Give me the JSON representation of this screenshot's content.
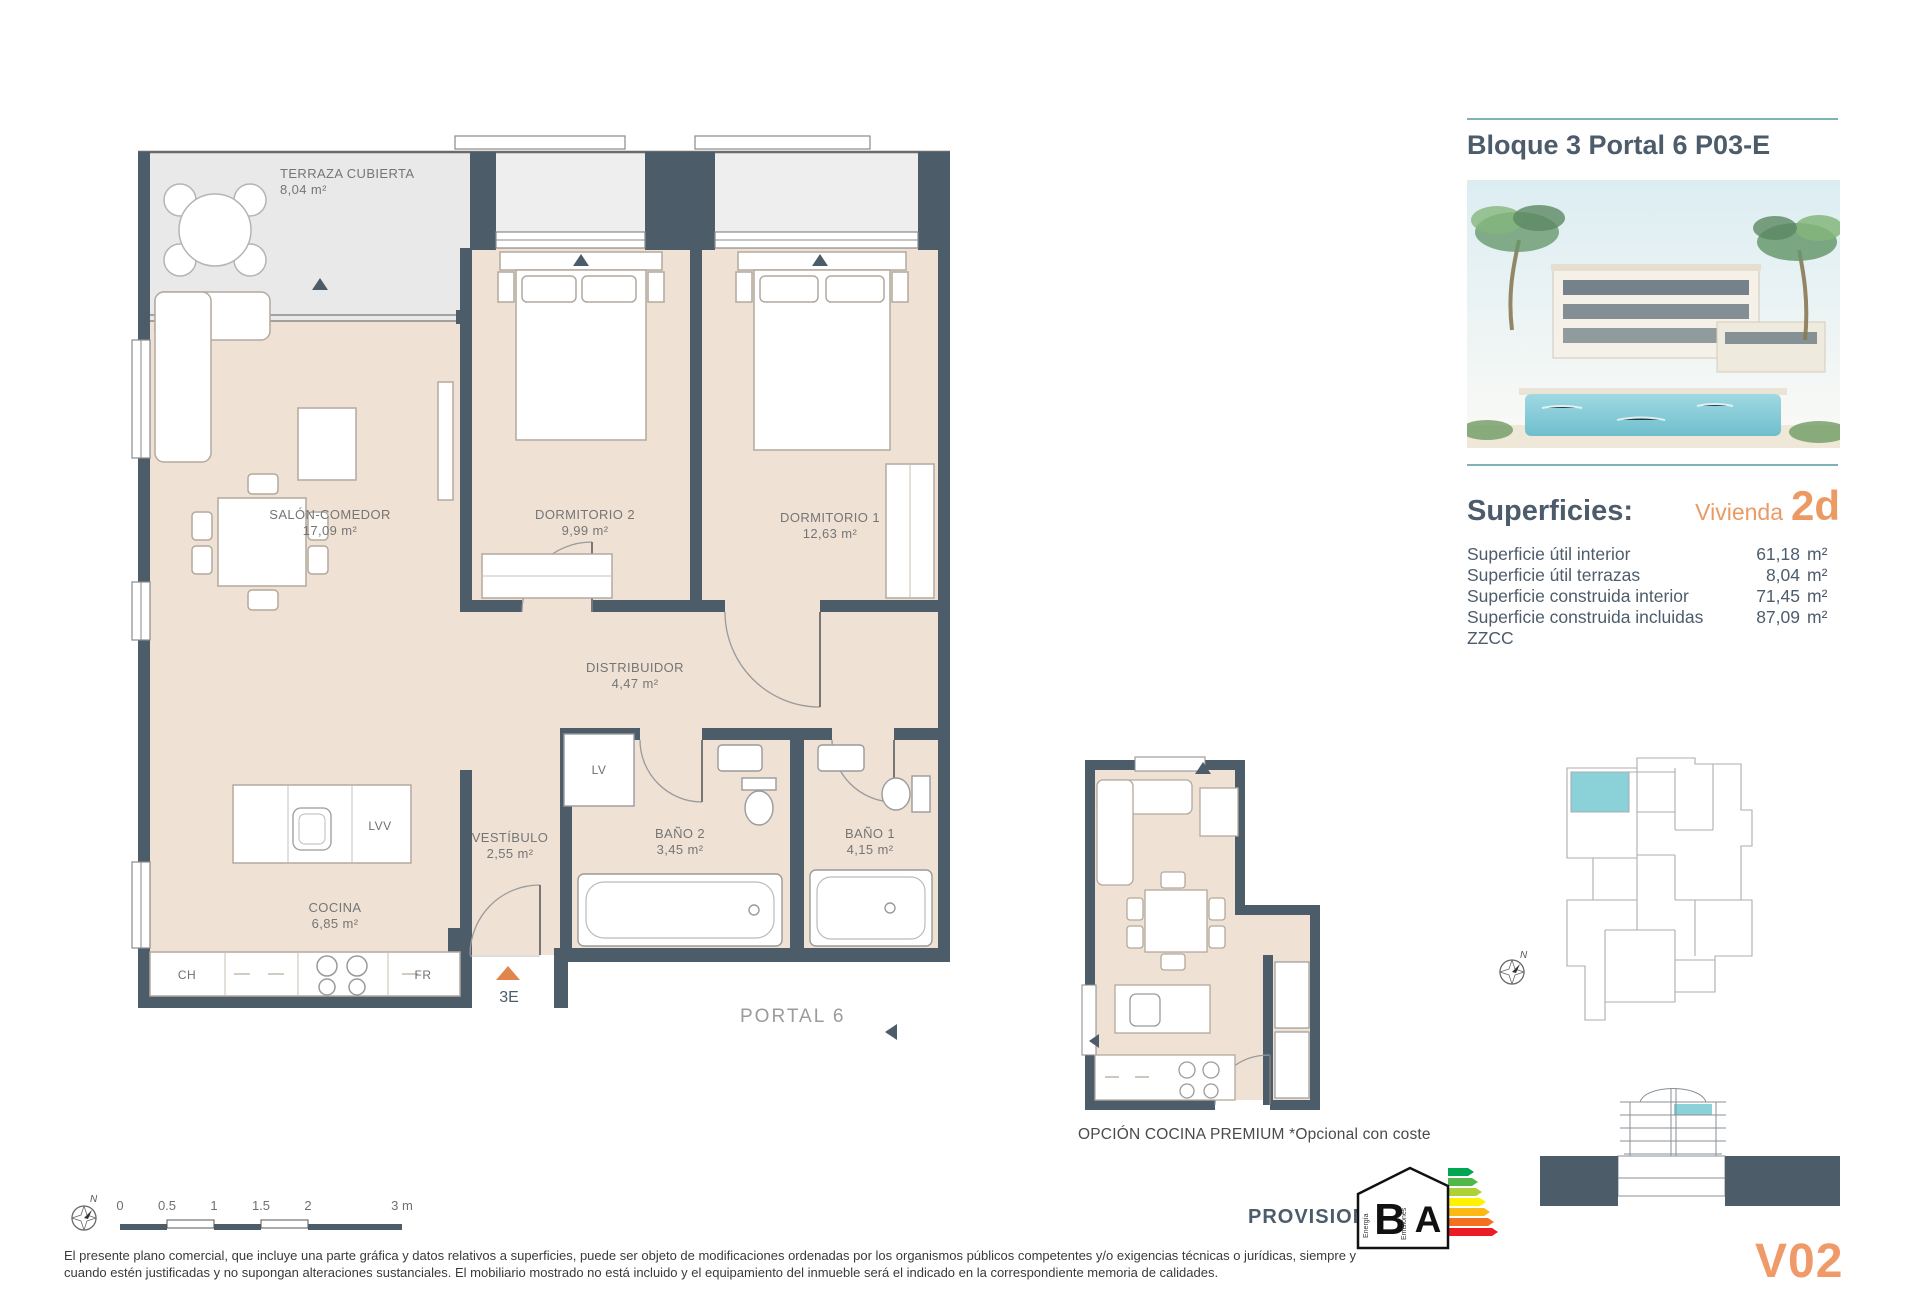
{
  "colors": {
    "wall": "#4d5c69",
    "floor_beige": "#efe2d5",
    "terrace_gray": "#e9e9e9",
    "accent_orange": "#eb9a63",
    "marker_orange": "#e0854c",
    "teal_rule": "#7fb2b6",
    "highlight_teal": "#8ad2d8",
    "label_gray": "#757575"
  },
  "main_plan": {
    "rooms": [
      {
        "name": "TERRAZA CUBIERTA",
        "area": "8,04 m²"
      },
      {
        "name": "SALÓN-COMEDOR",
        "area": "17,09 m²"
      },
      {
        "name": "DORMITORIO 2",
        "area": "9,99 m²"
      },
      {
        "name": "DORMITORIO 1",
        "area": "12,63 m²"
      },
      {
        "name": "DISTRIBUIDOR",
        "area": "4,47 m²"
      },
      {
        "name": "VESTÍBULO",
        "area": "2,55 m²"
      },
      {
        "name": "BAÑO 2",
        "area": "3,45 m²"
      },
      {
        "name": "BAÑO 1",
        "area": "4,15 m²"
      },
      {
        "name": "COCINA",
        "area": "6,85 m²"
      }
    ],
    "fixtures": {
      "lv": "LV",
      "lvv": "LVV",
      "ch": "CH",
      "fr": "FR"
    },
    "unit_marker": "3E",
    "portal_label": "PORTAL 6"
  },
  "premium_plan": {
    "caption": "OPCIÓN COCINA PREMIUM *Opcional con coste"
  },
  "info_panel": {
    "title": "Bloque 3 Portal 6 P03-E",
    "superficies_heading": "Superficies:",
    "vivienda_label": "Vivienda",
    "vivienda_code": "2d",
    "rows": [
      {
        "label": "Superficie útil interior",
        "value": "61,18",
        "unit": "m²"
      },
      {
        "label": "Superficie útil terrazas",
        "value": "8,04",
        "unit": "m²"
      },
      {
        "label": "Superficie construida interior",
        "value": "71,45",
        "unit": "m²"
      },
      {
        "label": "Superficie construida incluidas ZZCC",
        "value": "87,09",
        "unit": "m²"
      }
    ]
  },
  "footer": {
    "disclaimer_line1": "El presente plano comercial, que incluye una parte gráfica y datos relativos a superficies, puede ser objeto de modificaciones ordenadas por los organismos públicos competentes y/o exigencias técnicas o jurídicas, siempre y",
    "disclaimer_line2": "cuando estén justificadas y no supongan alteraciones sustanciales. El mobiliario mostrado no está incluido y el equipamiento del inmueble será el indicado en la correspondiente memoria de calidades.",
    "provisional": "PROVISIONAL",
    "version": "V02",
    "scale_ticks": [
      "0",
      "0.5",
      "1",
      "1.5",
      "2",
      "3 m"
    ],
    "north_letter": "N",
    "energy": {
      "letter_b": "B",
      "letter_a": "A",
      "energia": "Energía",
      "emisiones": "Emisiones"
    }
  }
}
